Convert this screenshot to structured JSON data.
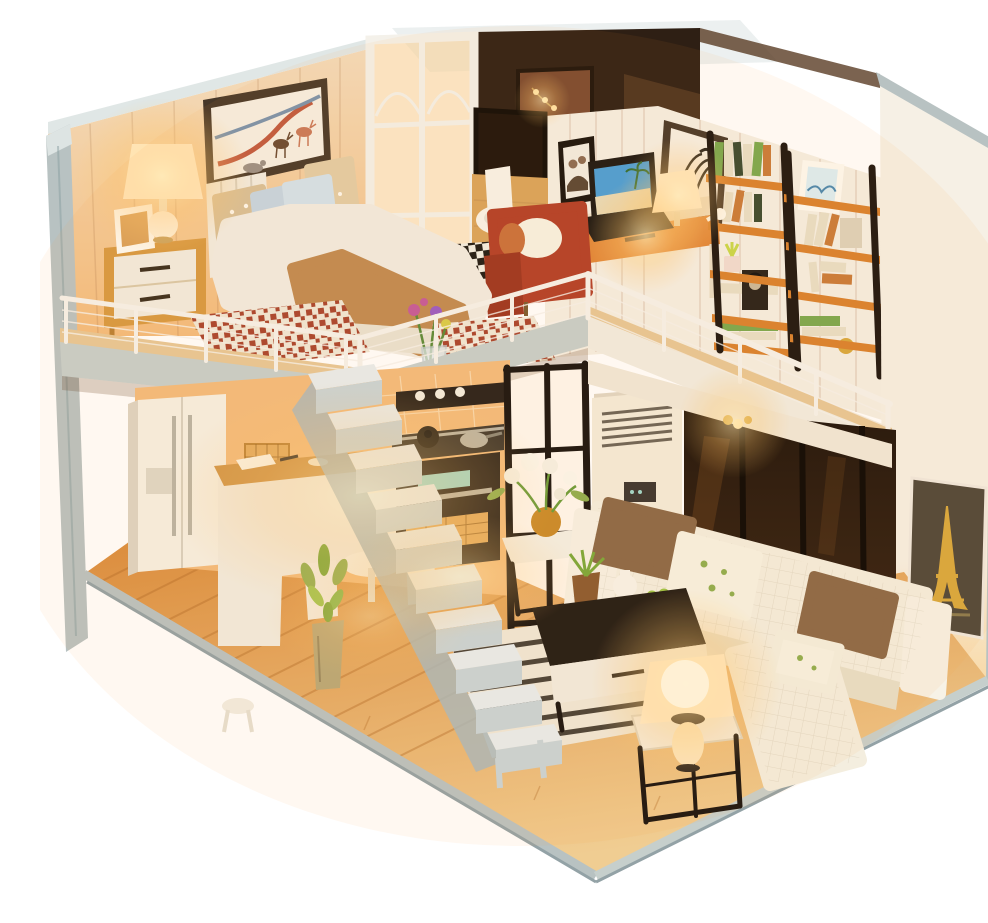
{
  "meta": {
    "type": "product-photo",
    "subject": "Illuminated DIY miniature dollhouse kit — modern two-story loft apartment, open front, on white background",
    "visible_text": "none"
  },
  "palette": {
    "bg": "#ffffff",
    "edge_grey": "#b8c2c2",
    "edge_grey_dark": "#93a2a6",
    "edge_light": "#dde4e3",
    "wall_wood": "#f3dcbd",
    "wall_wood_warm": "#f3bc7d",
    "wall_white": "#f5efe4",
    "wall_right": "#f6f0e5",
    "partition_white": "#f4f1ea",
    "pane_warm": "#f8d9a6",
    "attic_dark": "#2e1f14",
    "attic_mid": "#5a3c24",
    "poster": "#7a4a30",
    "glow_core": "#ffedb8",
    "glow_mid": "#ffc86e",
    "glow_veil": "#ff9c3a",
    "floor_back": "#d98b3c",
    "floor_front": "#f0cd92",
    "floor_gap": "#b06a28",
    "slab_wood": "#e7c897",
    "slab_grey": "#c6cfcc",
    "slab_white": "#f1ede2",
    "railing": "#f6f3ec",
    "stair_tread": "#e8edee",
    "stair_riser": "#c9d4d8",
    "stair_shadow": "#a9b8bd",
    "fridge": "#f6f0e4",
    "fridge_shadow": "#ddd4c4",
    "metal": "#b9b4a6",
    "counter_wood": "#cf9448",
    "cabinet_rattan": "#e2aa5e",
    "oven_black": "#27201a",
    "display_teal": "#9fd8cc",
    "partition_black": "#181310",
    "ac_body": "#f4ecdb",
    "ac_grille": "#6b6458",
    "window_dark": "#1c120a",
    "window_mull": "#090604",
    "beam_white": "#f0e9da",
    "sofa": "#f4eedf",
    "sofa_shadow": "#e7dfc9",
    "pillow_brown": "#8a6847",
    "pillow_floral": "#f7f3e4",
    "leaf_green": "#8fae4f",
    "table_black": "#201a14",
    "drawer_white": "#f2ece0",
    "rug_base": "#efe8d8",
    "rug_stripe": "#2b241c",
    "rug_red": "#a8442f",
    "duvet": "#f1ece2",
    "blanket": "#c08a52",
    "pillow_dot": "#d8c098",
    "pillow_blue": "#c5d6e2",
    "headboard": "#f2ece0",
    "nightstand": "#d79942",
    "art_frame": "#473829",
    "art_paper": "#f6efe3",
    "ribbon_red": "#c05a40",
    "ribbon_blue": "#7a93ad",
    "deer_red": "#c9795a",
    "deer_brown": "#6a4a32",
    "deer_grey": "#9a9086",
    "eiffel_bg": "#4e463a",
    "eiffel_gold": "#d8a83e",
    "shelf_orange": "#d9822f",
    "shelf_rail": "#1c1510",
    "book_green": "#7aa84f",
    "book_cream": "#e8dfc8",
    "book_orange": "#c97b3a",
    "book_dark": "#3a4a30",
    "chair_red": "#b23f28",
    "chair_red_dark": "#9c3521",
    "toilet": "#f8f4ea",
    "checker_dark": "#1e1a16",
    "wood_trim": "#d9a45c",
    "laptop_dark": "#1b1713",
    "sky_blue": "#4a9fd8",
    "sand": "#e8dbb8",
    "vase_metal": "#b9a878",
    "apple_green": "#9ec446",
    "flower_pink": "#c45a9a",
    "flower_purple": "#9a5ac4",
    "lamp_shade": "#fff4dc",
    "lamp_core": "#fff8e2"
  },
  "scene": {
    "structure": {
      "label": "dollhouse shell",
      "left_wall": "grey exterior side wall",
      "right_wall": "white exterior side wall with grey edges",
      "roof_panel": "clear acrylic roof sheet over attic nook",
      "base": "wood plank floor platform with grey front edges",
      "staircase": "white open staircase to loft",
      "loft_railing": "white wire loft railing",
      "glass_partition_white": "white-framed glass partition beside bed",
      "glass_partition_black": "black-framed glass partition beside kitchen"
    },
    "upper_floor": {
      "bedroom": {
        "label": "loft bedroom",
        "items": [
          "deer-and-ribbons wall art",
          "double bed with fluffy duvet and caramel throw",
          "polka-dot and blue pillows",
          "white slat headboard",
          "wooden nightstand with white drawers",
          "lit white table lamp",
          "leaning photo frame",
          "red houndstooth rugs",
          "flower vase at loft edge"
        ]
      },
      "bathroom": {
        "label": "bathroom nook",
        "items": [
          "dark framed mirror window",
          "white toilet",
          "checkerboard tile floor",
          "wood trim wall"
        ]
      },
      "study": {
        "label": "study loft",
        "items": [
          "red armchair with cream pillow",
          "family photo frame",
          "zebra wall art",
          "string lights",
          "wooden desk with orange drawer",
          "laptop showing beach wallpaper",
          "lit desk lamp",
          "two black-and-orange ladder bookshelves",
          "books",
          "white bird figurine",
          "succulent planter",
          "portrait print",
          "gold ornament"
        ]
      },
      "attic": {
        "label": "attic nook",
        "items": [
          "dark wood wall",
          "poster",
          "warm light bulb"
        ]
      }
    },
    "lower_floor": {
      "kitchen": {
        "label": "kitchen",
        "items": [
          "double-door refrigerator with steel handles",
          "rattan lattice cabinets",
          "wood-top counter with papers",
          "open shelf with dishes",
          "black oven with teal display",
          "stovetop with pot and pan",
          "wicker drawers"
        ]
      },
      "dining": {
        "label": "dining nook",
        "items": [
          "round white table",
          "two white chairs"
        ]
      },
      "living_room": {
        "label": "living room",
        "items": [
          "white quilted L-shaped sofa",
          "brown cushions",
          "floral cushions",
          "black coffee table with white drawer",
          "potted plant",
          "white teapot",
          "bowl of green apples",
          "flower side table",
          "black cube side table",
          "lit table lamp",
          "striped rug",
          "floor plant in metal vase",
          "white stool",
          "Eiffel Tower print",
          "floor-standing air conditioner",
          "dark glass window wall",
          "pendant light"
        ]
      }
    },
    "lighting": {
      "label": "warm LED interior lighting",
      "glows": [
        "bedroom lamp",
        "attic bulb",
        "desk lamp",
        "string lights",
        "kitchen wash",
        "stove underlight",
        "loft pendant",
        "living room lamp",
        "under-stair wash"
      ]
    }
  }
}
